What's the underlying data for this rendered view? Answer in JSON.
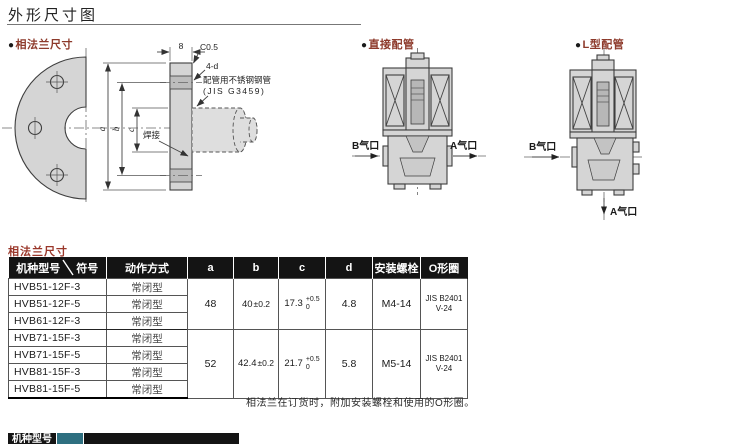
{
  "title": "外形尺寸图",
  "flange_section": {
    "bullet": "●",
    "label": "相法兰尺寸",
    "dim_8": "8",
    "chamfer": "C0.5",
    "hole_note": "4-d",
    "pipe_note_line1": "配管用不锈钢钢管",
    "pipe_note_line2": "(JIS G3459)",
    "weld_label": "焊接",
    "dim_a": "a",
    "dim_b": "b",
    "dim_c": "c"
  },
  "direct_pipe_section": {
    "bullet": "●",
    "label": "直接配管",
    "port_b": "B气口",
    "port_a": "A气口"
  },
  "l_pipe_section": {
    "bullet": "●",
    "label": "L型配管",
    "port_b": "B气口",
    "port_a": "A气口"
  },
  "table": {
    "caption": "相法兰尺寸",
    "col_model": "机种型号",
    "col_symbol": "符号",
    "col_action": "动作方式",
    "col_a": "a",
    "col_b": "b",
    "col_c": "c",
    "col_d": "d",
    "col_bolt": "安装螺栓",
    "col_oring": "O形圈",
    "groups": [
      {
        "rows": [
          {
            "model": "HVB51-12F-3",
            "action": "常闭型"
          },
          {
            "model": "HVB51-12F-5",
            "action": "常闭型"
          },
          {
            "model": "HVB61-12F-3",
            "action": "常闭型"
          }
        ],
        "a": "48",
        "b_value": "40",
        "b_tol": "±0.2",
        "c_value": "17.3",
        "c_tol_upper": "+0.5",
        "c_tol_lower": "0",
        "d": "4.8",
        "bolt": "M4-14",
        "oring_line1": "JIS B2401",
        "oring_line2": "V-24"
      },
      {
        "rows": [
          {
            "model": "HVB71-15F-3",
            "action": "常闭型"
          },
          {
            "model": "HVB71-15F-5",
            "action": "常闭型"
          },
          {
            "model": "HVB81-15F-3",
            "action": "常闭型"
          },
          {
            "model": "HVB81-15F-5",
            "action": "常闭型"
          }
        ],
        "a": "52",
        "b_value": "42.4",
        "b_tol": "±0.2",
        "c_value": "21.7",
        "c_tol_upper": "+0.5",
        "c_tol_lower": "0",
        "d": "5.8",
        "bolt": "M5-14",
        "oring_line1": "JIS B2401",
        "oring_line2": "V-24"
      }
    ],
    "footnote": "相法兰在订货时，附加安装螺栓和使用的O形圈。",
    "next_table_partial_header": "机种型号"
  },
  "colors": {
    "accent_red": "#8d3a2b",
    "table_header_bg": "#141414",
    "drawing_fill": "#d5d5d5"
  }
}
